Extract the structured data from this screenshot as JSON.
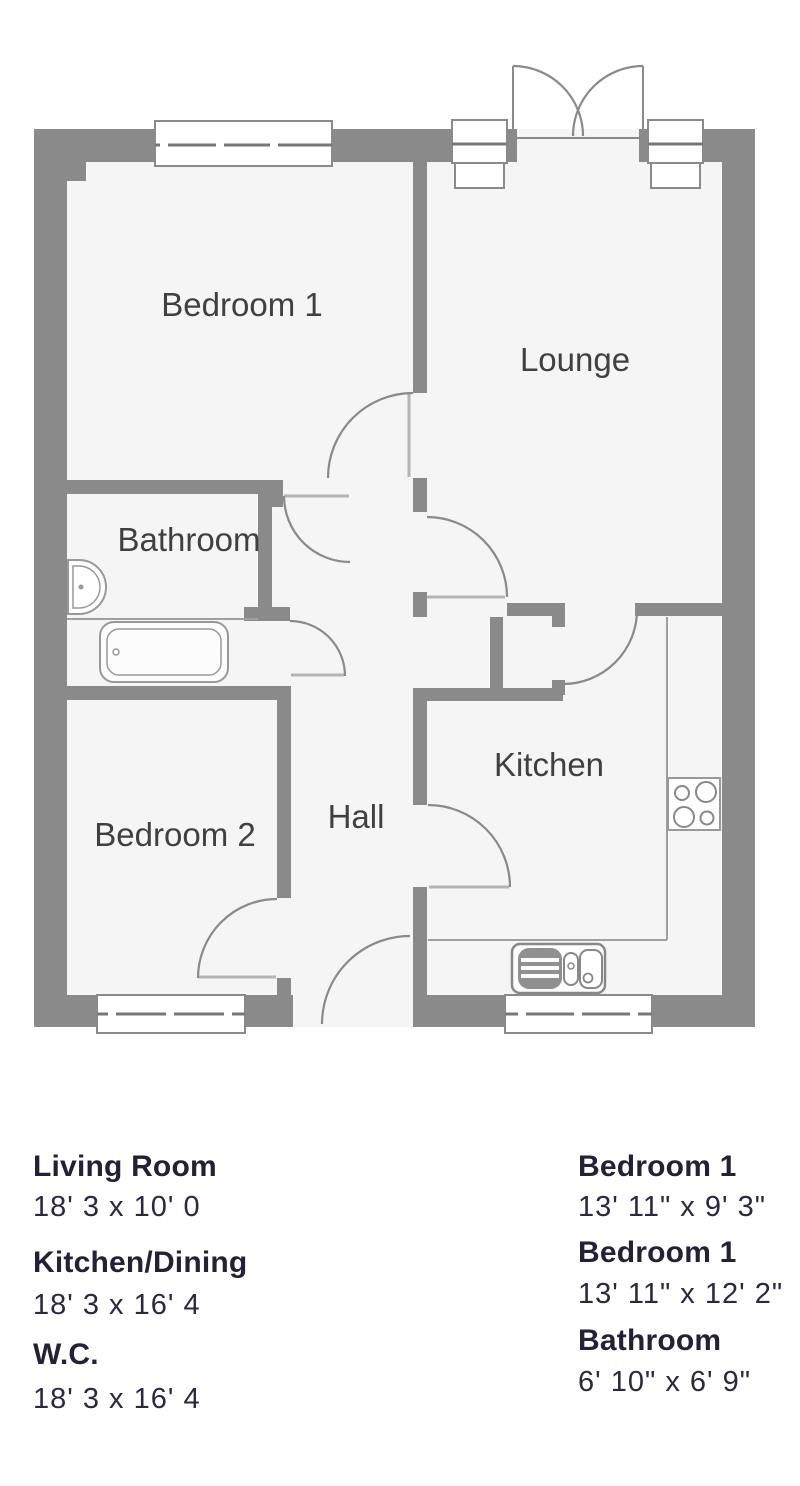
{
  "plan": {
    "labels": {
      "bedroom1": "Bedroom 1",
      "lounge": "Lounge",
      "bathroom": "Bathroom",
      "bedroom2": "Bedroom 2",
      "hall": "Hall",
      "kitchen": "Kitchen"
    },
    "colors": {
      "wall": "#8a8a8a",
      "room_fill": "#f5f5f5",
      "thin_line": "#a0a0a0",
      "label_text": "#404040"
    }
  },
  "legend": {
    "text_color": "#232135",
    "left": [
      {
        "name": "Living Room",
        "dims": "18' 3 x 10' 0"
      },
      {
        "name": "Kitchen/Dining",
        "dims": "18' 3 x 16' 4"
      },
      {
        "name": "W.C.",
        "dims": "18' 3 x 16' 4"
      }
    ],
    "right": [
      {
        "name": "Bedroom 1",
        "dims": "13' 11\" x 9' 3\""
      },
      {
        "name": "Bedroom 1",
        "dims": "13' 11\" x 12' 2\""
      },
      {
        "name": "Bathroom",
        "dims": "6' 10\" x 6' 9\""
      }
    ]
  }
}
